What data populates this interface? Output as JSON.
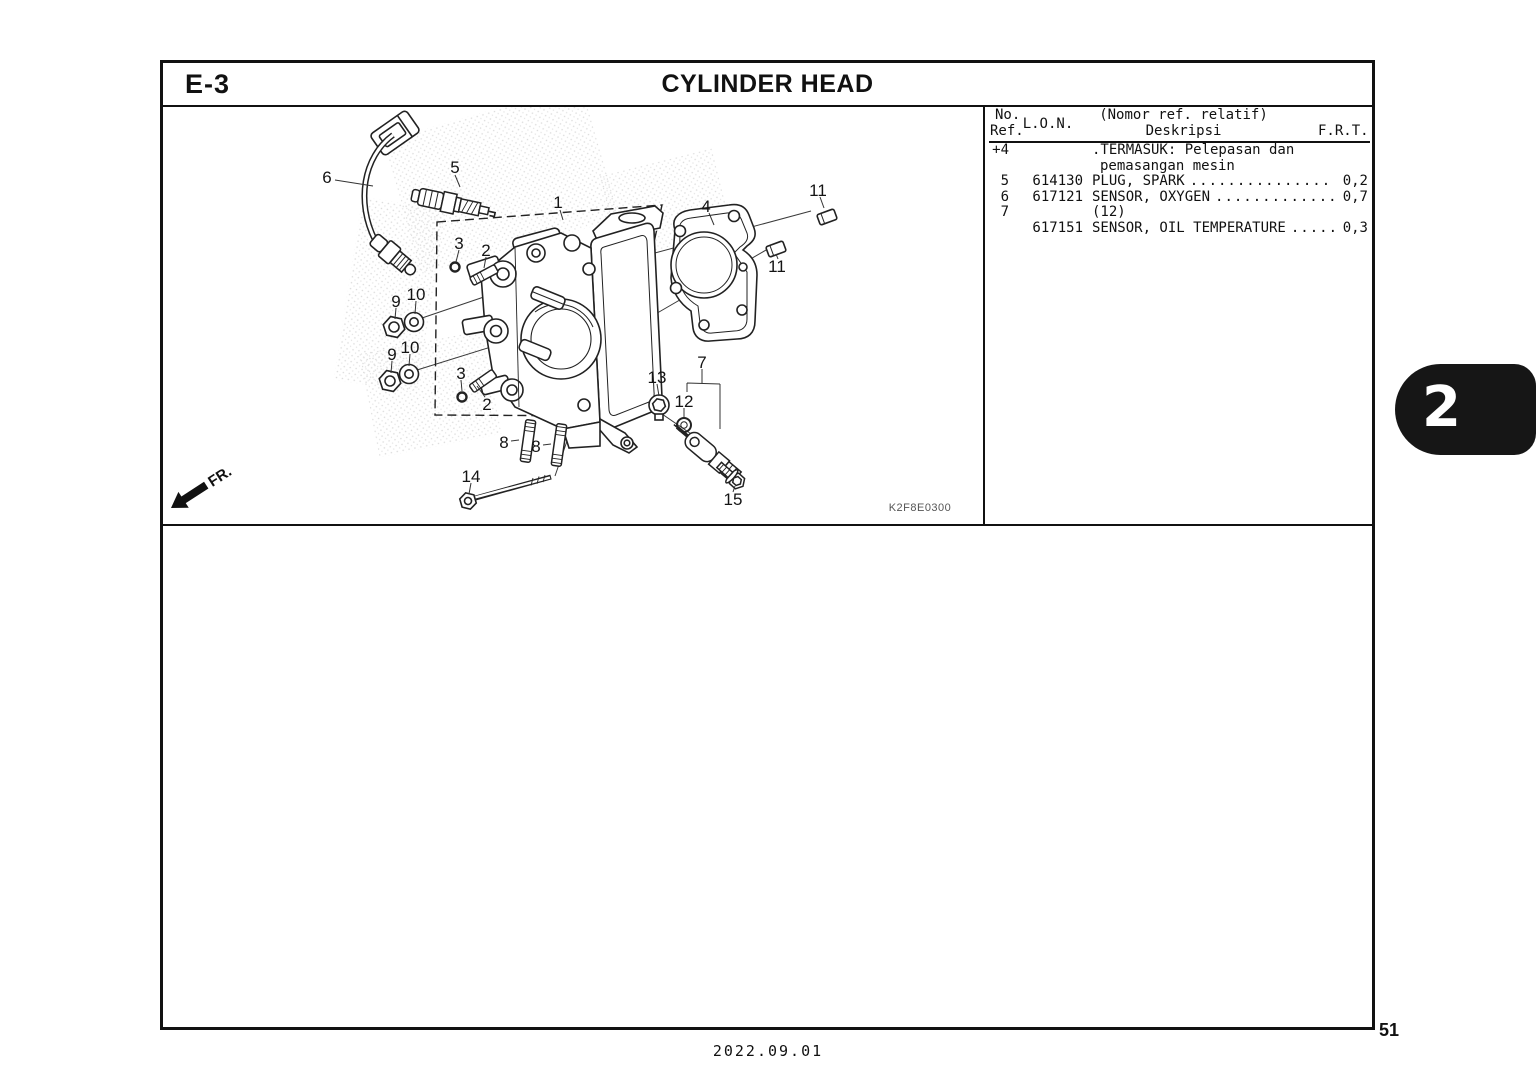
{
  "header": {
    "code": "E-3",
    "title": "CYLINDER HEAD"
  },
  "table": {
    "headers": {
      "no": "No.",
      "ref": "Ref.",
      "lon": "L.O.N.",
      "desc_top": "(Nomor ref. relatif)",
      "desc_bottom": "Deskripsi",
      "frt": "F.R.T."
    },
    "leader_dots": ".............................................",
    "rows": [
      {
        "ref": "+4",
        "lon": "",
        "desc": ".TERMASUK: Pelepasan dan",
        "indent": 0,
        "leader": false,
        "frt": ""
      },
      {
        "ref": "",
        "lon": "",
        "desc": "pemasangan mesin",
        "indent": 1,
        "leader": false,
        "frt": ""
      },
      {
        "ref": "5",
        "lon": "614130",
        "desc": "PLUG, SPARK",
        "indent": 0,
        "leader": true,
        "frt": "0,2"
      },
      {
        "ref": "6",
        "lon": "617121",
        "desc": "SENSOR, OXYGEN",
        "indent": 0,
        "leader": true,
        "frt": "0,7"
      },
      {
        "ref": "7",
        "lon": "",
        "desc": "(12)",
        "indent": 0,
        "leader": false,
        "frt": ""
      },
      {
        "ref": "",
        "lon": "617151",
        "desc": "SENSOR, OIL TEMPERATURE",
        "indent": 0,
        "leader": true,
        "frt": "0,3"
      }
    ]
  },
  "diagram": {
    "code": "K2F8E0300",
    "fr_label": "FR.",
    "callouts": [
      {
        "label": "1",
        "x": 395,
        "y": 95
      },
      {
        "label": "2",
        "x": 323,
        "y": 143
      },
      {
        "label": "2",
        "x": 324,
        "y": 297
      },
      {
        "label": "3",
        "x": 296,
        "y": 136
      },
      {
        "label": "3",
        "x": 298,
        "y": 266
      },
      {
        "label": "4",
        "x": 543,
        "y": 99
      },
      {
        "label": "5",
        "x": 292,
        "y": 60
      },
      {
        "label": "6",
        "x": 164,
        "y": 70
      },
      {
        "label": "7",
        "x": 539,
        "y": 255
      },
      {
        "label": "8",
        "x": 341,
        "y": 335
      },
      {
        "label": "8",
        "x": 373,
        "y": 339
      },
      {
        "label": "9",
        "x": 233,
        "y": 194
      },
      {
        "label": "9",
        "x": 229,
        "y": 247
      },
      {
        "label": "10",
        "x": 253,
        "y": 187
      },
      {
        "label": "10",
        "x": 247,
        "y": 240
      },
      {
        "label": "11",
        "x": 655,
        "y": 83
      },
      {
        "label": "11",
        "x": 614,
        "y": 159
      },
      {
        "label": "12",
        "x": 521,
        "y": 294
      },
      {
        "label": "13",
        "x": 494,
        "y": 270
      },
      {
        "label": "14",
        "x": 308,
        "y": 369
      },
      {
        "label": "15",
        "x": 570,
        "y": 392
      }
    ]
  },
  "tab": {
    "label": "2"
  },
  "footer": {
    "page": "51",
    "date": "2022.09.01"
  }
}
